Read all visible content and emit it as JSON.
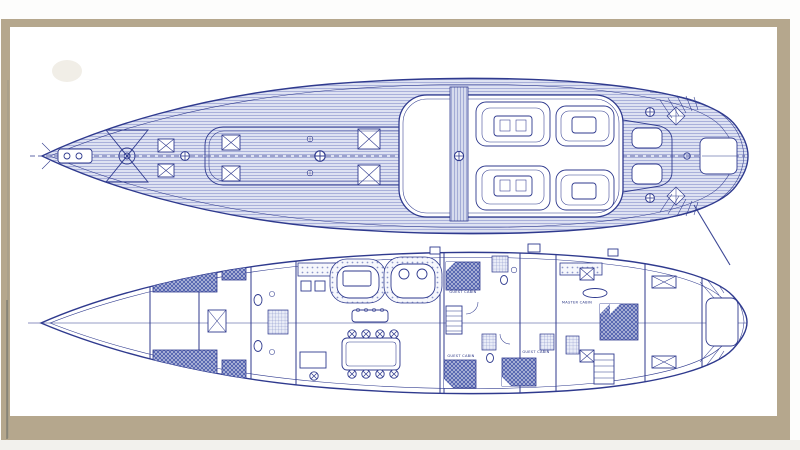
{
  "labels": {
    "forward_guest_cabin": "GUEST CABIN",
    "master_cabin": "MASTER CABIN",
    "aft_guest_cabin_1": "GUEST CABIN",
    "aft_guest_cabin_2": "GUEST CABIN"
  },
  "colors": {
    "frame_tan": "#b5a78d",
    "ink_navy": "#2f3a8e",
    "deck_plank_tint": "#dee2f2",
    "furniture_blue": "#5a69b2",
    "paper_white": "#ffffff"
  }
}
